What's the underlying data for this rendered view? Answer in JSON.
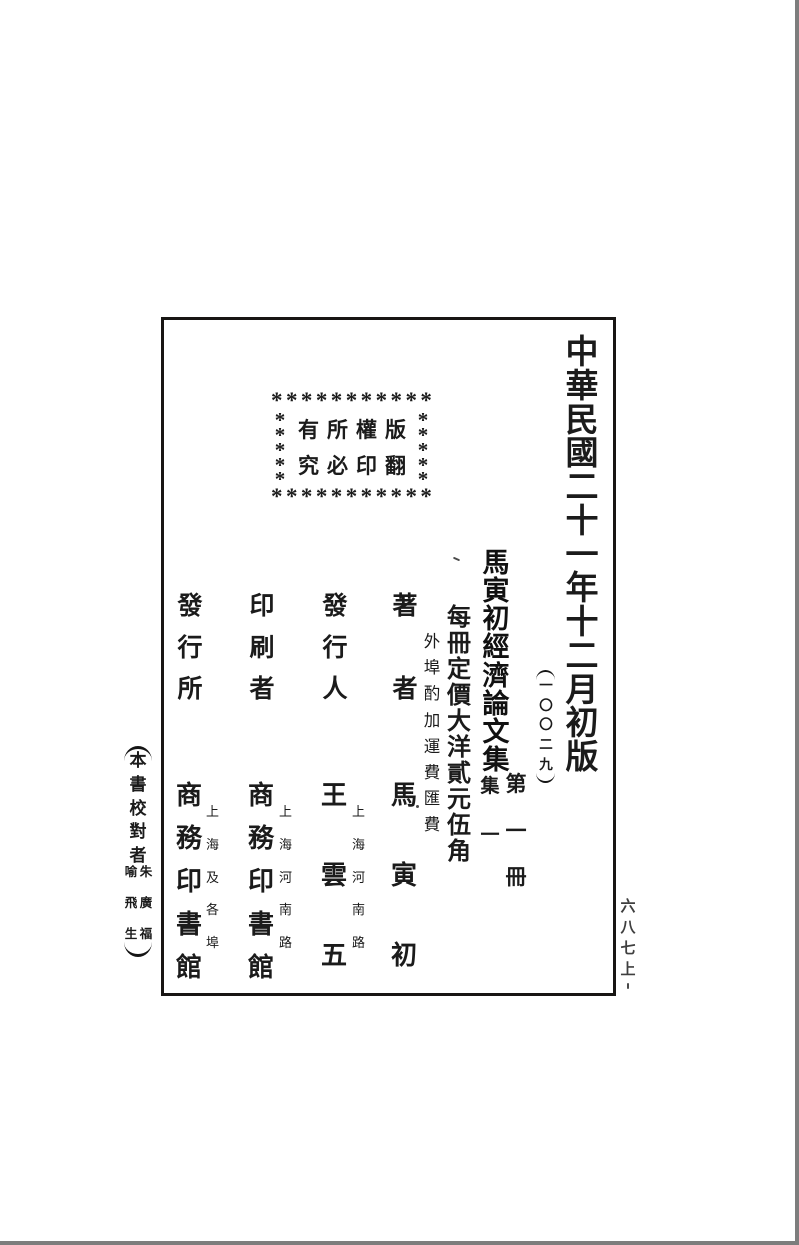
{
  "document": {
    "edition_line": "中華民國二十一年十二月初版",
    "serial_number": "一〇〇二九",
    "copyright_box": {
      "phrase_1": "版權所有",
      "phrase_2": "翻印必究",
      "stars_top": "***********",
      "stars_bottom": "***********",
      "stars_left": "*****",
      "stars_right": "*****"
    },
    "title": "馬寅初經濟論文集",
    "volume_note": {
      "main": "第一冊",
      "side": "集一"
    },
    "price_line": "每冊定價大洋貳元伍角",
    "price_note": "外埠酌加運費匯費",
    "colophon": {
      "author_label": "著者",
      "author_name": "馬寅初",
      "publisher_label": "發行人",
      "publisher_name": "王雲五",
      "publisher_location": "上海河南路",
      "printer_label": "印刷者",
      "printer_name": "商務印書館",
      "printer_location": "上海河南路",
      "distributor_label": "發行所",
      "distributor_name": "商務印書館",
      "distributor_location": "上海及各埠"
    },
    "proofreader_note": {
      "label": "本書校對者",
      "name_1": "朱廣福",
      "name_2": "喻飛生"
    },
    "folio_number": "六八七上"
  }
}
